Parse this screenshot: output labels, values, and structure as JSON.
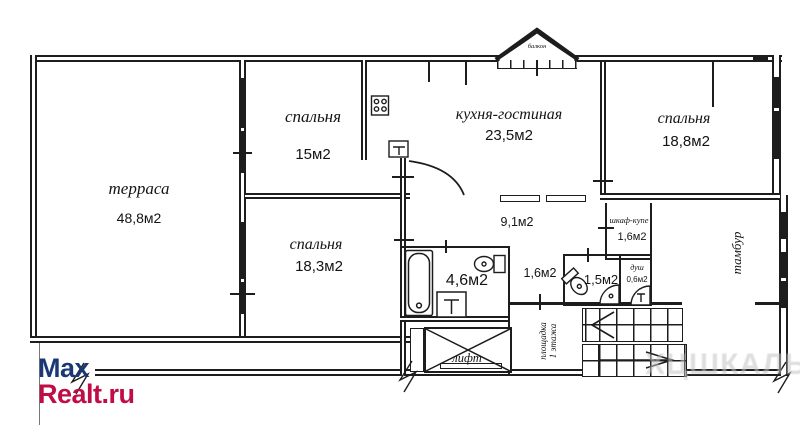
{
  "rooms": {
    "terrace": {
      "name": "терраса",
      "area": "48,8м2"
    },
    "bedroom_top": {
      "name": "спальня",
      "area": "15м2"
    },
    "kitchen_living": {
      "name": "кухня-гостиная",
      "area": "23,5м2"
    },
    "bedroom_right": {
      "name": "спальня",
      "area": "18,8м2"
    },
    "bedroom_bottom": {
      "name": "спальня",
      "area": "18,3м2"
    },
    "hallway": {
      "area": "9,1м2"
    },
    "wardrobe": {
      "name": "шкаф-купе",
      "area": "1,6м2"
    },
    "corridor": {
      "area": "1,6м2"
    },
    "bathroom": {
      "area": "4,6м2"
    },
    "wc": {
      "area": "1,5м2"
    },
    "shower": {
      "name": "душ",
      "area": "0,6м2"
    },
    "tambour": {
      "name": "тамбур"
    },
    "lift": {
      "name": "лифт"
    },
    "landing": {
      "line1": "площадка",
      "line2": "1 этажа"
    },
    "balcony": {
      "name": "балкон"
    }
  },
  "logo": {
    "line1": "Max",
    "line2": "Realt.ru",
    "color1": "#1b3876",
    "color2": "#c00d45"
  },
  "watermark": {
    "text": "ХЦШКАЛЬ"
  },
  "wall_color": "#1d1d1d"
}
